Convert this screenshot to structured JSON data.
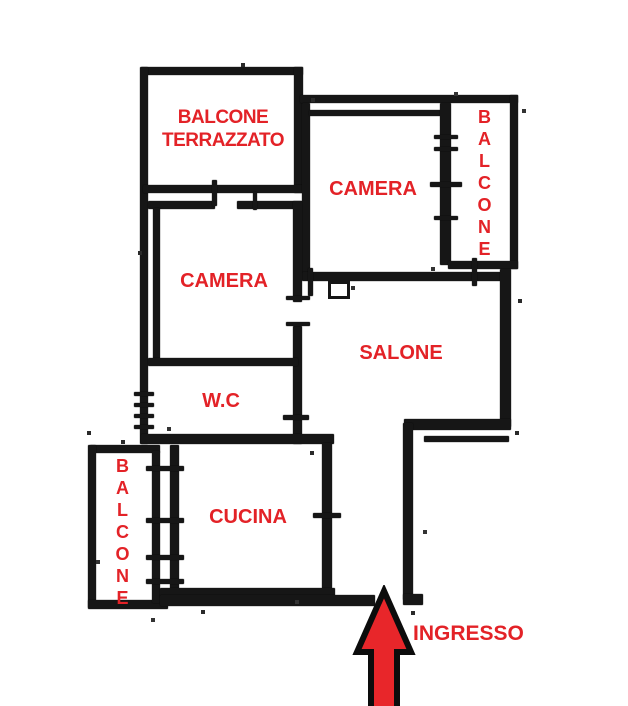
{
  "rooms": {
    "balcone_terrazzato": {
      "label": "BALCONE TERRAZZATO"
    },
    "camera_top": {
      "label": "CAMERA"
    },
    "balcone_right": {
      "label": "BALCONE"
    },
    "camera_mid": {
      "label": "CAMERA"
    },
    "salone": {
      "label": "SALONE"
    },
    "wc": {
      "label": "W.C"
    },
    "balcone_left": {
      "label": "BALCONE"
    },
    "cucina": {
      "label": "CUCINA"
    },
    "ingresso": {
      "label": "INGRESSO"
    }
  },
  "arrow": {
    "meaning": "entrance direction",
    "direction": "up"
  },
  "colors": {
    "label_red": "#e32227",
    "arrow_red": "#e8262a",
    "wall_black": "#161616"
  }
}
